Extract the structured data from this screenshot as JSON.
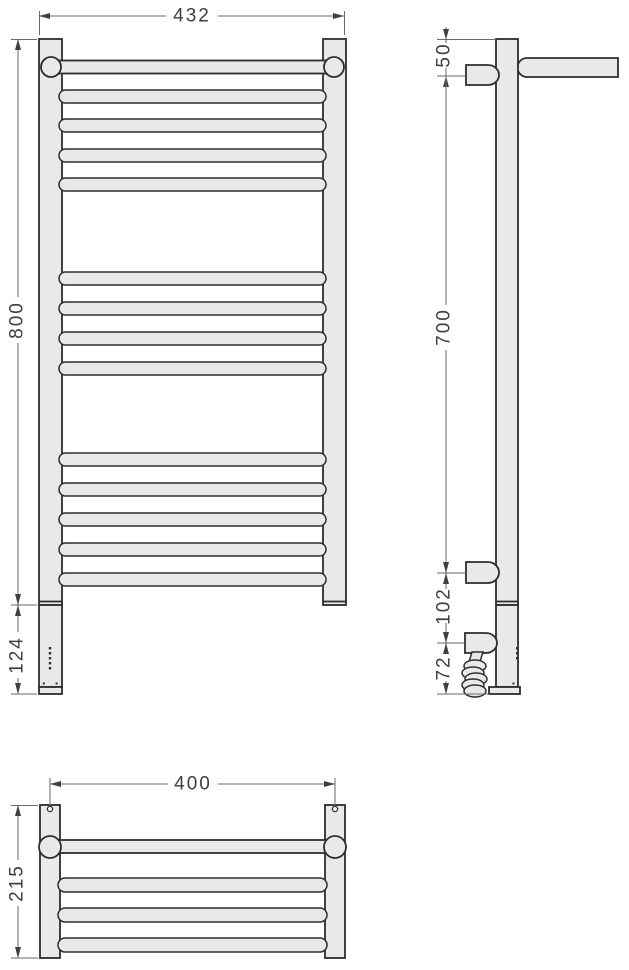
{
  "front_view": {
    "width_mm": "432",
    "height_mm": "800",
    "lower_section_mm": "124"
  },
  "side_view": {
    "top_to_upper_bracket_mm": "50",
    "bracket_spacing_mm": "700",
    "bracket_to_heater_mm": "102",
    "heater_to_bottom_mm": "72"
  },
  "top_view": {
    "mounting_centers_mm": "400",
    "depth_mm": "215"
  },
  "colors": {
    "background": "#ffffff",
    "part_fill": "#e9e9e9",
    "part_outline": "#2d2d2d",
    "dimension_lines": "#6a6a6a",
    "dimension_text": "#3f3f3f"
  }
}
